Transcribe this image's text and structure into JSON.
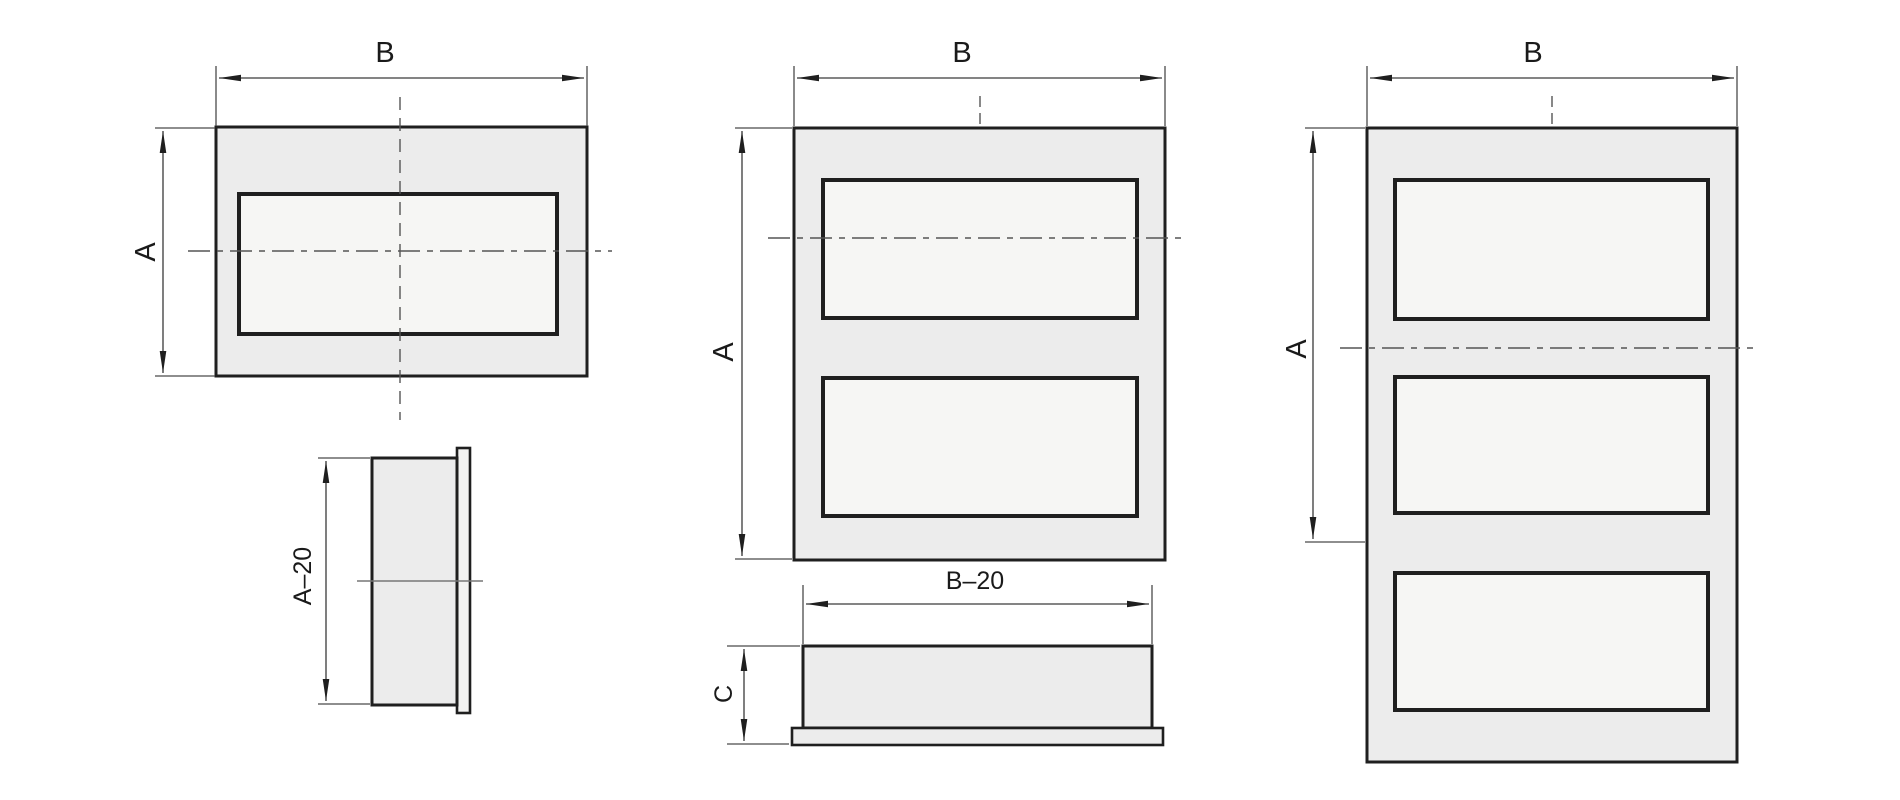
{
  "drawing": {
    "labels": {
      "single_front_width": "B",
      "single_front_height": "A",
      "single_side_height": "A–20",
      "double_front_width": "B",
      "double_front_height": "A",
      "double_side_width": "B–20",
      "double_side_height": "C",
      "triple_front_width": "B",
      "triple_front_height": "A"
    },
    "colors": {
      "background": "#ffffff",
      "object_line": "#1f1f1f",
      "dimension_line": "#3a3a3a",
      "centerline": "#555555",
      "panel_fill": "#ececec",
      "opening_fill": "#f6f6f4",
      "seam_line": "#777777",
      "label_text": "#1a1a1a"
    }
  }
}
